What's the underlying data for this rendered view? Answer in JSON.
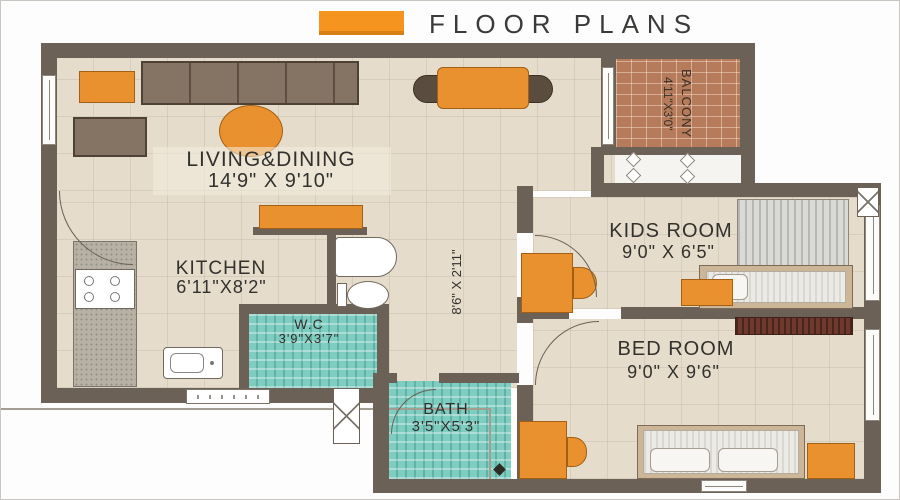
{
  "header": {
    "title": "FLOOR PLANS",
    "accent_color": "#F5941E"
  },
  "rooms": {
    "living": {
      "name": "LIVING&DINING",
      "dims": "14'9\" X 9'10\""
    },
    "kitchen": {
      "name": "KITCHEN",
      "dims": "6'11\"X8'2\""
    },
    "wc": {
      "name": "W.C",
      "dims": "3'9\"X3'7\""
    },
    "bath": {
      "name": "BATH",
      "dims": "3'5\"X5'3\""
    },
    "kids": {
      "name": "KIDS  ROOM",
      "dims": "9'0\"  X  6'5\""
    },
    "bed": {
      "name": "BED  ROOM",
      "dims": "9'0\"  X  9'6\""
    },
    "balcony": {
      "name": "BALCONY",
      "dims": "4'11\"X3'0\""
    },
    "passage": {
      "dims": "8'6\" X 2'11\""
    }
  },
  "colors": {
    "wall": "#6b6157",
    "floor": "#e5dccb",
    "tile": "#7fccc1",
    "brick": "#b67b5b",
    "furniture_accent": "#E8912E",
    "text": "#33312d"
  }
}
